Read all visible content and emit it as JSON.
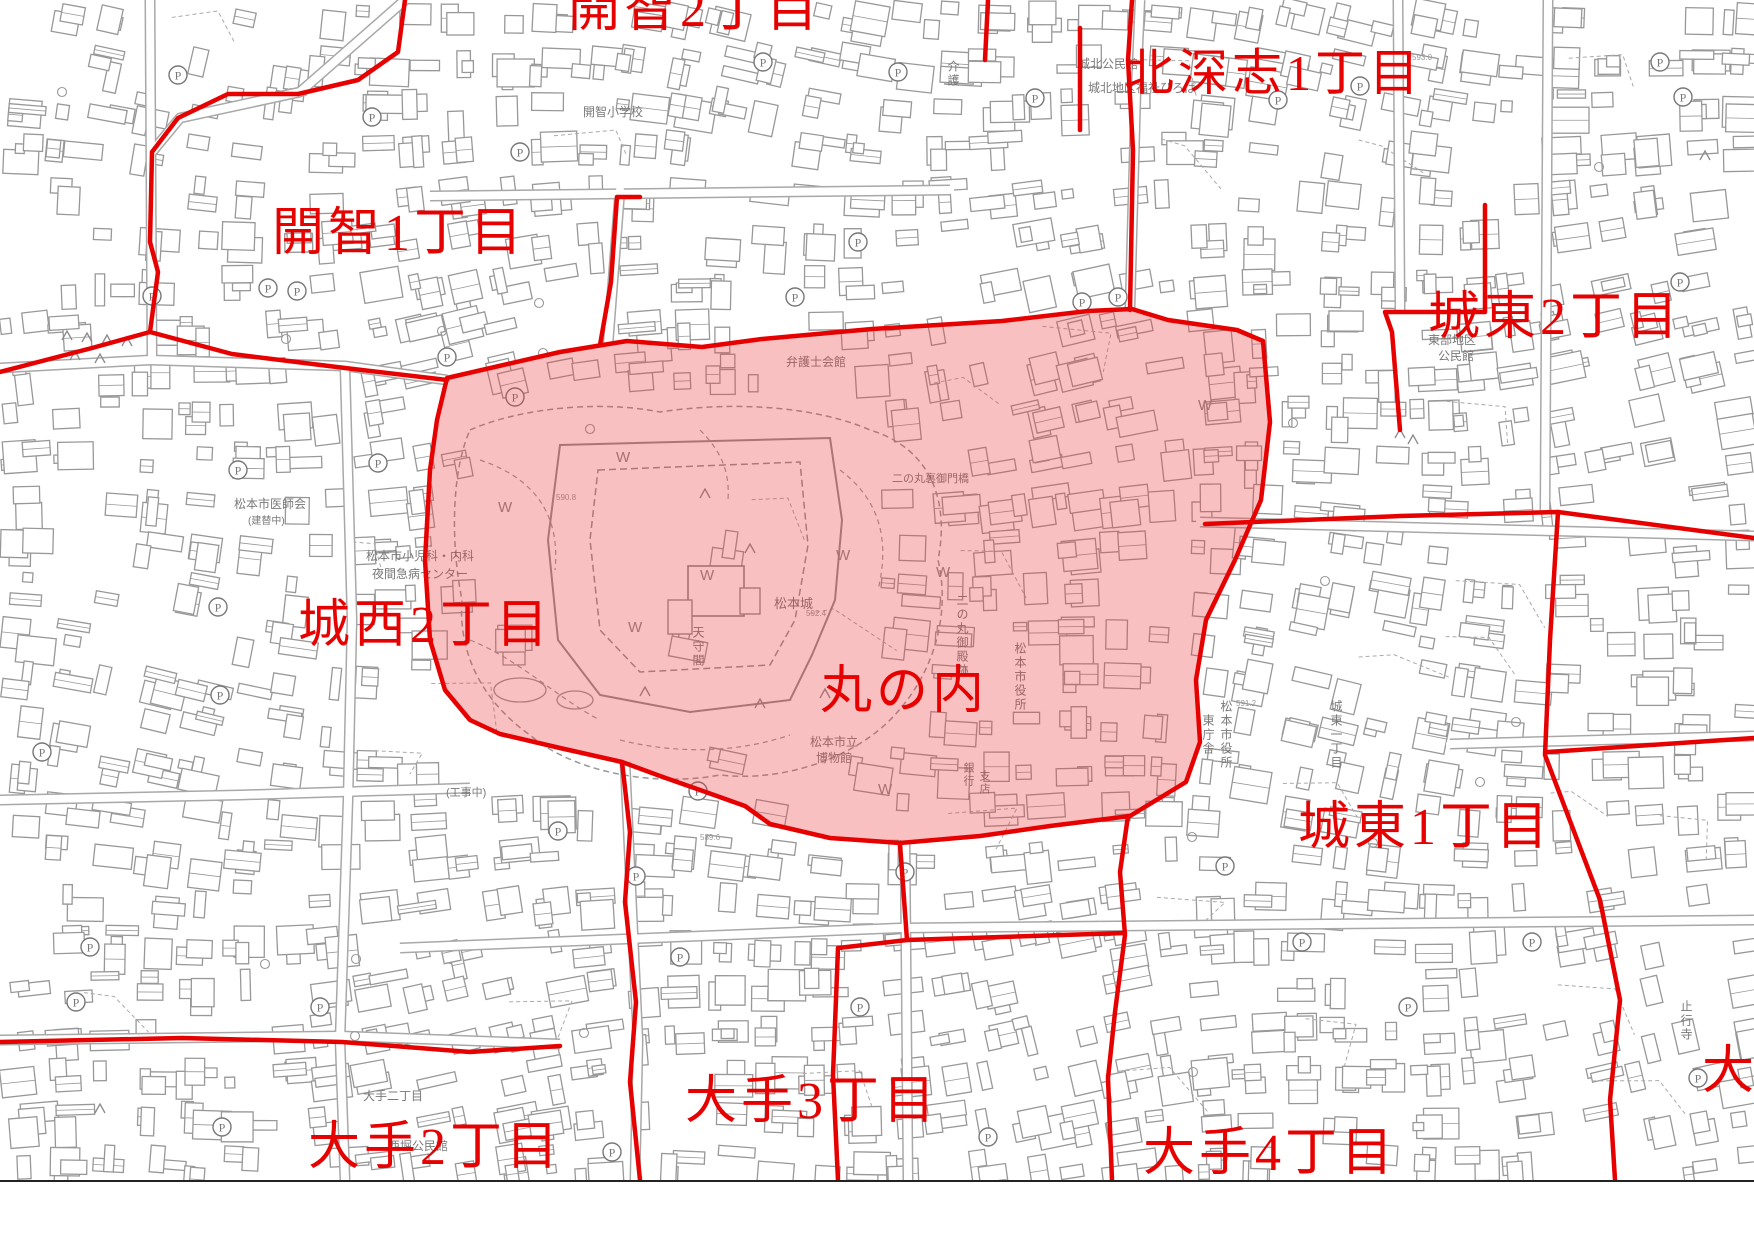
{
  "map": {
    "region_name": "丸の内",
    "highlighted_area": {
      "label": "丸の内",
      "fill": "#ea3b3b",
      "fill_opacity": 0.32,
      "border_color": "#e60000"
    },
    "colors": {
      "boundary_red": "#e60000",
      "map_line_gray": "#989898",
      "label_gray": "#787878",
      "background": "#ffffff"
    },
    "symbols": {
      "parking_icon": "P",
      "water_icon": "W",
      "tree_icon": "triangle"
    },
    "district_labels": [
      {
        "name": "kaichi-2chome-clipped",
        "text": "開智2丁目",
        "x": 568,
        "y": -16,
        "size": 52
      },
      {
        "name": "kaichi-1chome",
        "text": "開智1丁目",
        "x": 272,
        "y": 208,
        "size": 52
      },
      {
        "name": "kitafukashi-1chome",
        "text": "北深志1丁目",
        "x": 1124,
        "y": 48,
        "size": 50
      },
      {
        "name": "joto-2chome",
        "text": "城東2丁目",
        "x": 1428,
        "y": 292,
        "size": 52
      },
      {
        "name": "josei-2chome",
        "text": "城西2丁目",
        "x": 298,
        "y": 600,
        "size": 52
      },
      {
        "name": "marunouchi",
        "text": "丸の内",
        "x": 820,
        "y": 666,
        "size": 52
      },
      {
        "name": "joto-1chome",
        "text": "城東1丁目",
        "x": 1298,
        "y": 802,
        "size": 52
      },
      {
        "name": "ote-3chome",
        "text": "大手3丁目",
        "x": 685,
        "y": 1076,
        "size": 52
      },
      {
        "name": "ote-2chome",
        "text": "大手2丁目",
        "x": 308,
        "y": 1122,
        "size": 52
      },
      {
        "name": "ote-4chome",
        "text": "大手4丁目",
        "x": 1143,
        "y": 1128,
        "size": 52
      },
      {
        "name": "ote-right-partial",
        "text": "大",
        "x": 1702,
        "y": 1046,
        "size": 52
      }
    ],
    "place_labels": [
      {
        "text": "開智小学校",
        "x": 583,
        "y": 116
      },
      {
        "text": "城北公民館",
        "x": 1078,
        "y": 68
      },
      {
        "text": "城北地区福祉ひろば",
        "x": 1088,
        "y": 92
      },
      {
        "text": "介護",
        "x": 953,
        "y": 60,
        "vert": true
      },
      {
        "text": "弁護士会館",
        "x": 786,
        "y": 366
      },
      {
        "text": "東部地区",
        "x": 1428,
        "y": 344
      },
      {
        "text": "公民館",
        "x": 1438,
        "y": 360
      },
      {
        "text": "松本市医師会",
        "x": 234,
        "y": 508
      },
      {
        "text": "(建替中)",
        "x": 248,
        "y": 524,
        "size": 10
      },
      {
        "text": "松本市小児科・内科",
        "x": 366,
        "y": 560
      },
      {
        "text": "夜間急病センター",
        "x": 372,
        "y": 578
      },
      {
        "text": "二の丸裏御門橋",
        "x": 892,
        "y": 482,
        "size": 11
      },
      {
        "text": "松本城",
        "x": 774,
        "y": 608,
        "size": 13
      },
      {
        "text": "天守閣",
        "x": 698,
        "y": 626,
        "vert": true
      },
      {
        "text": "二の丸御殿跡",
        "x": 962,
        "y": 594,
        "vert": true
      },
      {
        "text": "松本市役所",
        "x": 1020,
        "y": 642,
        "vert": true
      },
      {
        "text": "松本市役所",
        "x": 1226,
        "y": 700,
        "vert": true
      },
      {
        "text": "東庁舎",
        "x": 1208,
        "y": 714,
        "vert": true
      },
      {
        "text": "松本市立",
        "x": 810,
        "y": 746
      },
      {
        "text": "博物館",
        "x": 816,
        "y": 762
      },
      {
        "text": "銀行",
        "x": 968,
        "y": 762,
        "vert": true,
        "size": 11
      },
      {
        "text": "支店",
        "x": 984,
        "y": 770,
        "vert": true,
        "size": 11
      },
      {
        "text": "城東一丁目",
        "x": 1336,
        "y": 700,
        "vert": true
      },
      {
        "text": "止行寺",
        "x": 1686,
        "y": 1000,
        "vert": true
      },
      {
        "text": "大手二丁目",
        "x": 363,
        "y": 1100
      },
      {
        "text": "西堀公民館",
        "x": 388,
        "y": 1150
      },
      {
        "text": "(工事中)",
        "x": 446,
        "y": 796,
        "size": 11
      }
    ],
    "water_marks": [
      [
        616,
        462
      ],
      [
        498,
        512
      ],
      [
        700,
        580
      ],
      [
        836,
        560
      ],
      [
        936,
        577
      ],
      [
        628,
        632
      ],
      [
        878,
        794
      ],
      [
        1198,
        410
      ]
    ],
    "elevation_marks": [
      {
        "text": "590.8",
        "x": 556,
        "y": 500
      },
      {
        "text": "592.4",
        "x": 806,
        "y": 616
      },
      {
        "text": "591.2",
        "x": 1236,
        "y": 706
      },
      {
        "text": "589.6",
        "x": 700,
        "y": 840
      },
      {
        "text": "593.0",
        "x": 1412,
        "y": 60
      }
    ]
  }
}
